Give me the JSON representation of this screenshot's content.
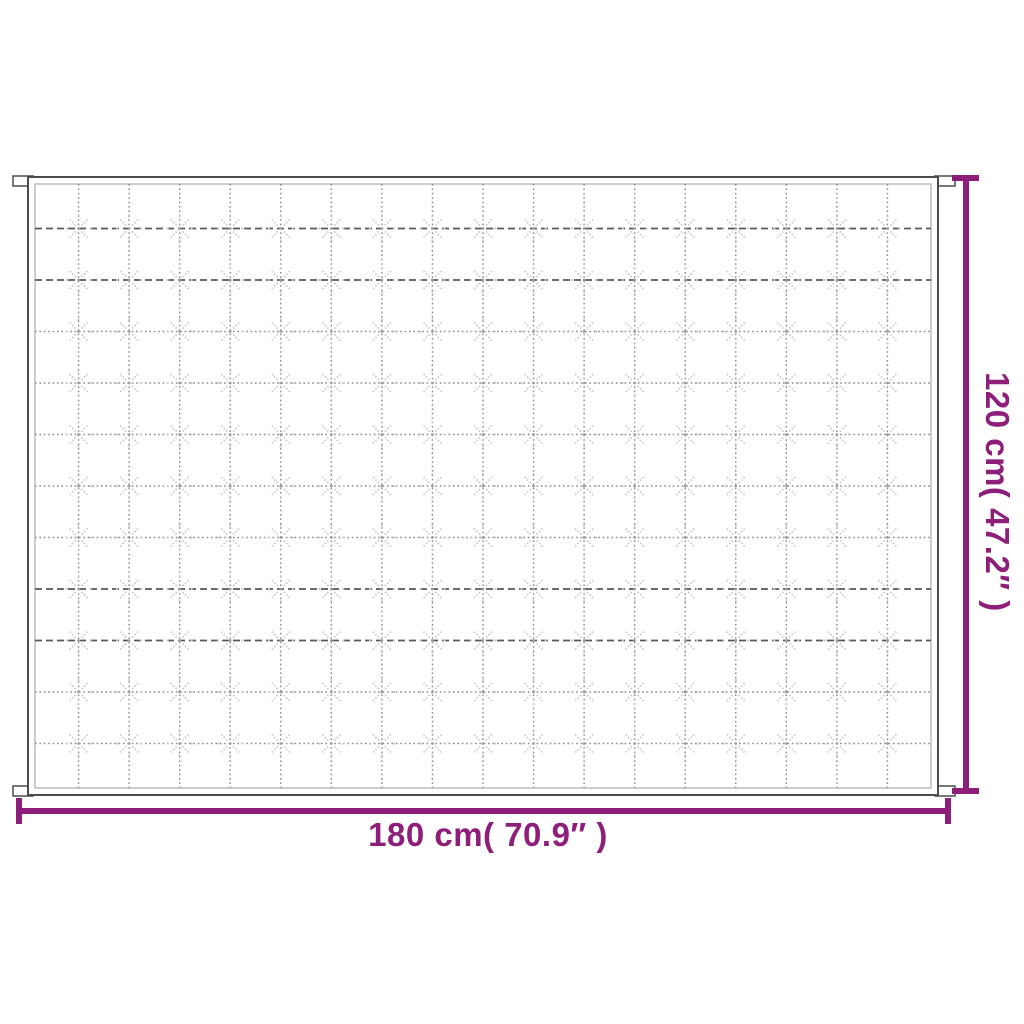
{
  "dimensions": {
    "width_label": "180 cm( 70.9″ )",
    "height_label": "120 cm( 47.2″ )"
  },
  "blanket": {
    "grid_columns": 18,
    "grid_rows": 12,
    "dark_horizontal_lines": [
      0,
      1,
      7,
      8
    ],
    "corner_tabs": [
      "top-left",
      "top-right",
      "bottom-left",
      "bottom-right"
    ]
  },
  "colors": {
    "accent": "#8d1e7a",
    "outline": "#4c4c4c",
    "seam": "#9b9b9b",
    "stitch": "#8a8a8a",
    "stitch_dark": "#585858",
    "tuft": "#c9c9c9",
    "tuft_center": "#9f9f9f",
    "background": "#ffffff"
  }
}
